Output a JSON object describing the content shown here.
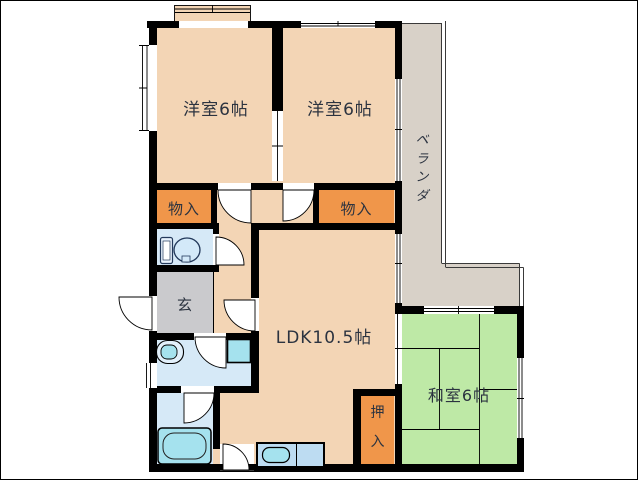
{
  "floorplan": {
    "rooms": {
      "bedroom1": {
        "label": "洋室6帖"
      },
      "bedroom2": {
        "label": "洋室6帖"
      },
      "veranda": {
        "label": "ベランダ",
        "chars": [
          "ベ",
          "ラ",
          "ン",
          "ダ"
        ]
      },
      "storage_left": {
        "label": "物入"
      },
      "storage_right": {
        "label": "物入"
      },
      "entrance": {
        "label": "玄"
      },
      "ldk": {
        "label": "LDK10.5帖"
      },
      "tatami_room": {
        "label": "和室6帖"
      },
      "closet": {
        "label": "押入",
        "chars": [
          "押",
          "入"
        ]
      }
    },
    "fixtures": {
      "toilet": "toilet-icon",
      "washbasin": "washbasin-icon",
      "washing_machine": "washing-machine-icon",
      "bathtub": "bathtub-icon",
      "kitchen_sink": "kitchen-sink-icon"
    },
    "colors": {
      "wall": "#000000",
      "peach": "#F3D5B5",
      "orange": "#F0964A",
      "green": "#BEE9A6",
      "roomblue": "#D6E9F7",
      "cyan": "#A5E2EE",
      "counter": "#BDDCF2",
      "veranda": "#D8D1C8",
      "genkan": "#CACACD",
      "text": "#2B3340",
      "thinline": "#3A3A3A"
    }
  }
}
